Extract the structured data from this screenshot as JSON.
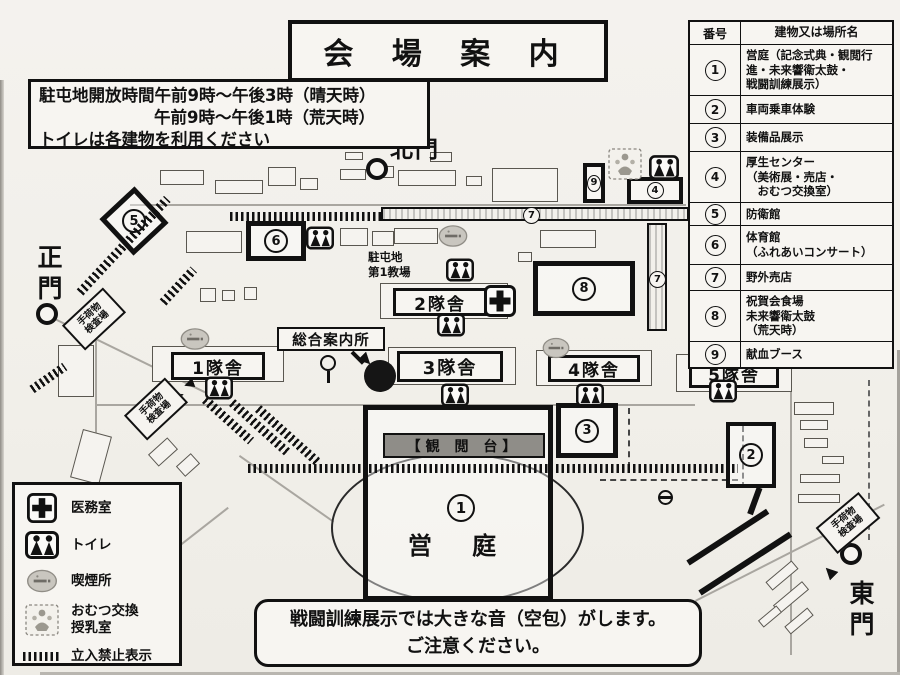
{
  "title": "会 場 案 内",
  "info_box": {
    "line1": "駐屯地開放時間午前9時～午後3時（晴天時）",
    "line2": "午前9時～午後1時（荒天時）",
    "line3": "トイレは各建物を利用ください"
  },
  "table": {
    "header_num": "番号",
    "header_name": "建物又は場所名",
    "rows": [
      {
        "num": "1",
        "name": "営庭（記念式典・観閲行\n進・未来響衛太鼓・\n戦闘訓練展示）"
      },
      {
        "num": "2",
        "name": "車両乗車体験"
      },
      {
        "num": "3",
        "name": "装備品展示"
      },
      {
        "num": "4",
        "name": "厚生センター\n（美術展・売店・\n　おむつ交換室）"
      },
      {
        "num": "5",
        "name": "防衛館"
      },
      {
        "num": "6",
        "name": "体育館\n（ふれあいコンサート）"
      },
      {
        "num": "7",
        "name": "野外売店"
      },
      {
        "num": "8",
        "name": "祝賀会食場\n未来響衛太鼓\n（荒天時）"
      },
      {
        "num": "9",
        "name": "献血ブース"
      }
    ]
  },
  "legend": {
    "items": [
      {
        "label": "医務室"
      },
      {
        "label": "トイレ"
      },
      {
        "label": "喫煙所"
      },
      {
        "label": "おむつ交換\n授乳室"
      },
      {
        "label": "立入禁止表示"
      }
    ]
  },
  "warning": {
    "line1": "戦闘訓練展示では大きな音（空包）がします。",
    "line2": "ご注意ください。"
  },
  "map": {
    "gates": {
      "north": "北門",
      "main": "正門",
      "east": "東門"
    },
    "labels": {
      "info_center": "総合案内所",
      "classroom": "駐屯地\n第1教場",
      "reviewing_stand": "【観 閲 台】",
      "parade_ground": "営 庭",
      "baggage_check": "手荷物\n検査場",
      "barracks1": "1隊舎",
      "barracks2": "2隊舎",
      "barracks3": "3隊舎",
      "barracks4": "4隊舎",
      "barracks5": "5隊舎"
    },
    "numbers": {
      "n1": "1",
      "n2": "2",
      "n3": "3",
      "n4": "4",
      "n5": "5",
      "n6": "6",
      "n7": "7",
      "n8": "8",
      "n9": "9"
    }
  }
}
